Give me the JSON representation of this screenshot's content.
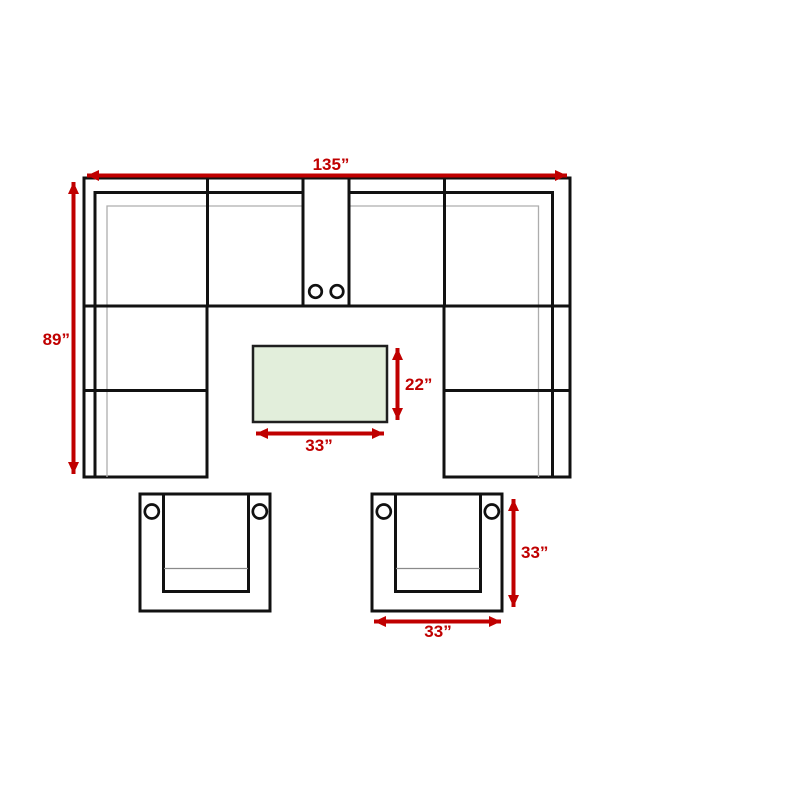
{
  "diagram": {
    "kind": "furniture-dimension-plan",
    "pieces": {
      "sectional_sofa": "u-shaped-sectional-with-console",
      "coffee_table": "rectangular-coffee-table",
      "armchairs": "two-club-chairs-with-cup-holders"
    },
    "labels": {
      "sofa_width": "135”",
      "sofa_depth": "89”",
      "table_depth": "22”",
      "table_width": "33”",
      "chair_depth": "33”",
      "chair_width": "33”"
    }
  },
  "colors": {
    "dimension": "#c00000",
    "outline": "#111111",
    "detail_line": "#adadad",
    "table_fill": "#e2eedb",
    "background": "#ffffff"
  }
}
